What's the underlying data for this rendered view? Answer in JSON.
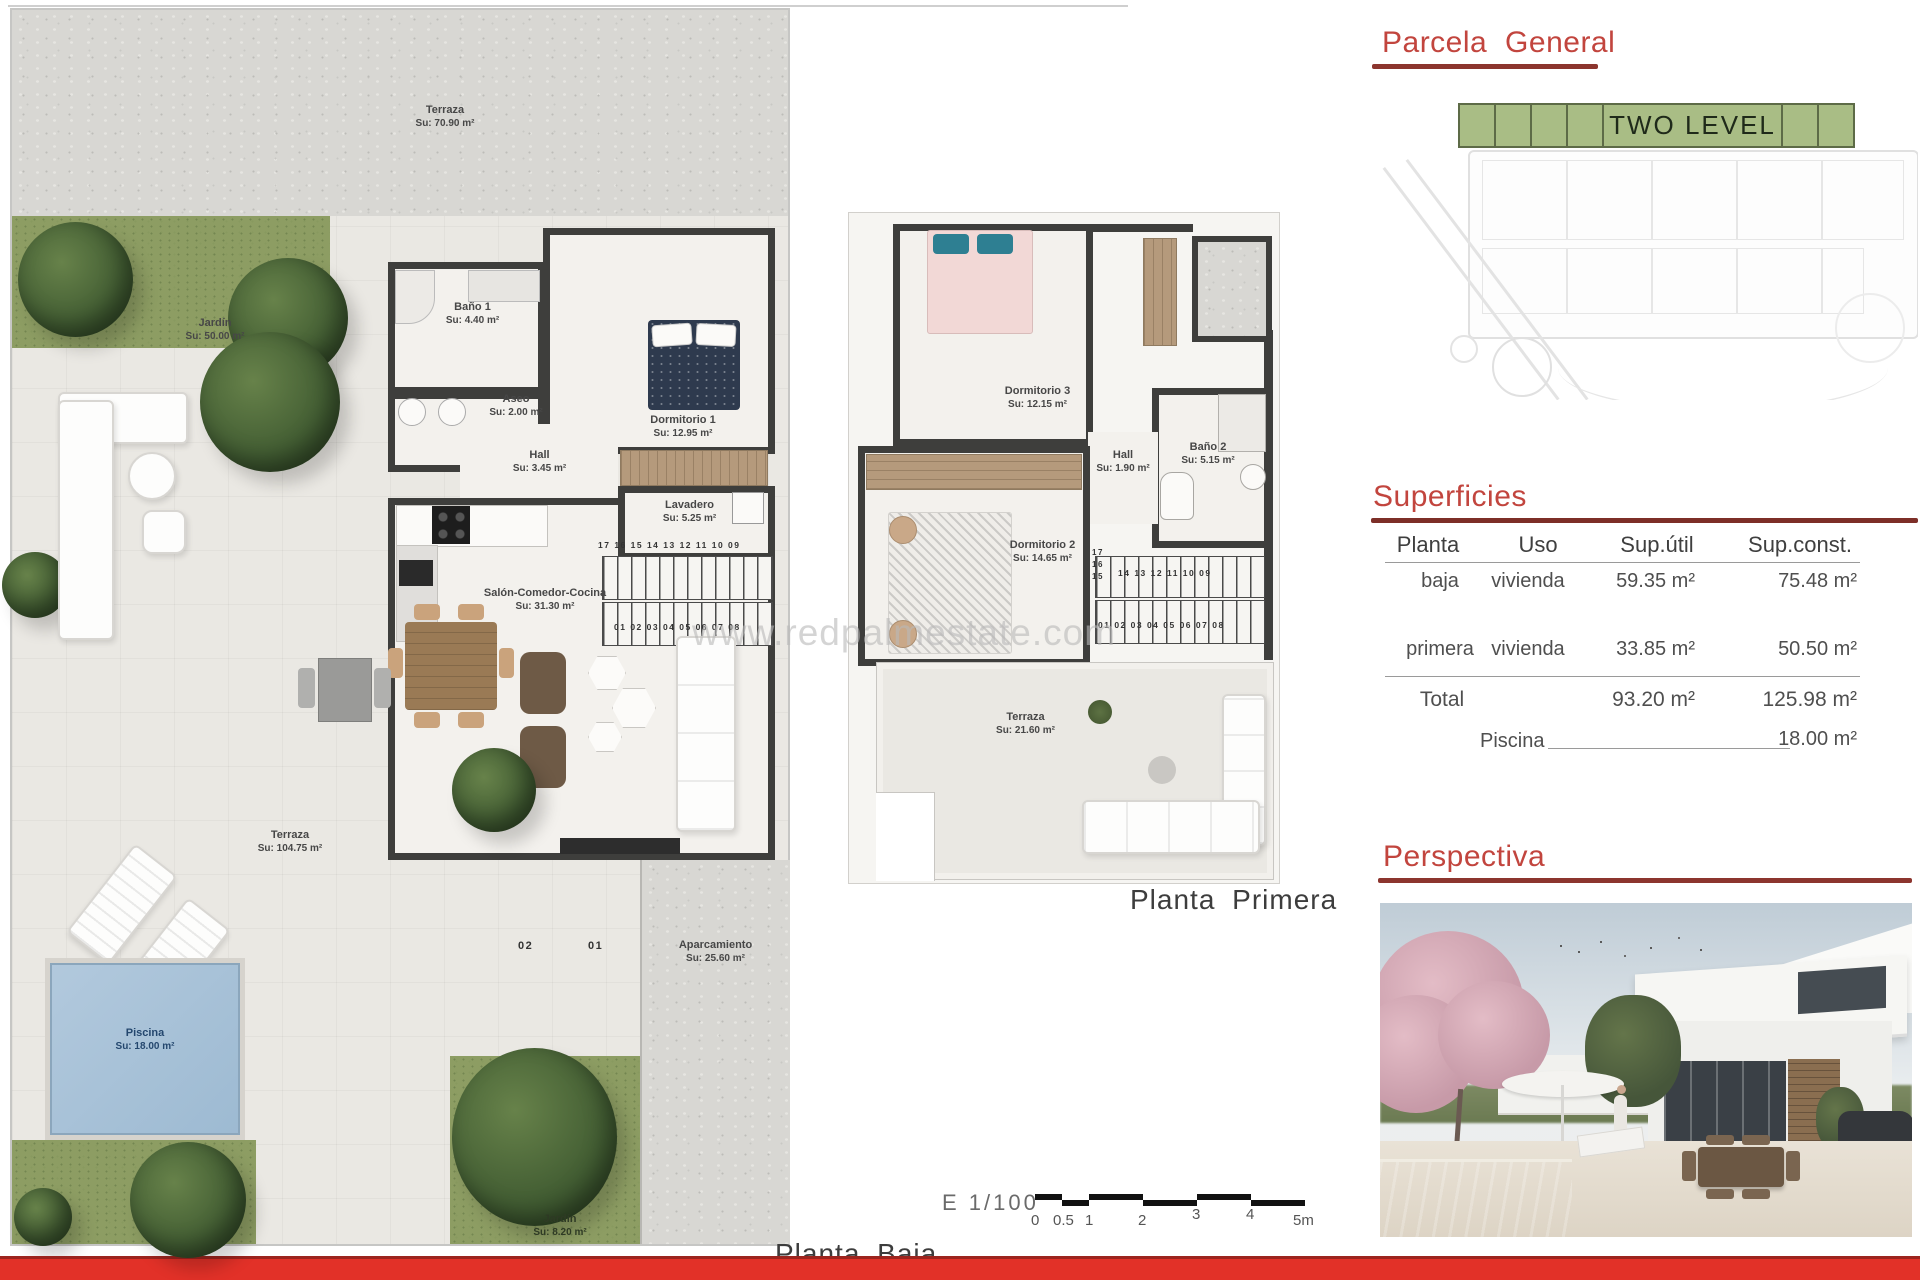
{
  "page": {
    "watermark": "www.redpalmestate.com"
  },
  "headings": {
    "parcela": "Parcela General",
    "superficies": "Superficies",
    "perspectiva": "Perspectiva"
  },
  "parcela": {
    "tag": "TWO LEVEL"
  },
  "superficies": {
    "columns": [
      "Planta",
      "Uso",
      "Sup.útil",
      "Sup.const."
    ],
    "rows": [
      {
        "planta": "baja",
        "uso": "vivienda",
        "util": "59.35 m²",
        "const": "75.48 m²"
      },
      {
        "planta": "primera",
        "uso": "vivienda",
        "util": "33.85 m²",
        "const": "50.50 m²"
      }
    ],
    "total_label": "Total",
    "total_util": "93.20 m²",
    "total_const": "125.98 m²",
    "piscina_label": "Piscina",
    "piscina_value": "18.00 m²"
  },
  "planta_baja": {
    "label": "Planta Baja",
    "terraza_top": {
      "name": "Terraza",
      "area": "Su: 70.90 m²"
    },
    "jardin": {
      "name": "Jardín",
      "area": "Su: 50.00 m²"
    },
    "bano1": {
      "name": "Baño 1",
      "area": "Su: 4.40 m²"
    },
    "aseo": {
      "name": "Aseo",
      "area": "Su: 2.00 m²"
    },
    "hall": {
      "name": "Hall",
      "area": "Su: 3.45 m²"
    },
    "dormitorio1": {
      "name": "Dormitorio 1",
      "area": "Su: 12.95 m²"
    },
    "lavadero": {
      "name": "Lavadero",
      "area": "Su: 5.25 m²"
    },
    "salon": {
      "name": "Salón-Comedor-Cocina",
      "area": "Su: 31.30 m²"
    },
    "terraza_main": {
      "name": "Terraza",
      "area": "Su: 104.75 m²"
    },
    "piscina": {
      "name": "Piscina",
      "area": "Su: 18.00 m²"
    },
    "aparcamiento": {
      "name": "Aparcamiento",
      "area": "Su: 25.60 m²"
    },
    "jardin_bottom": {
      "name": "Jardín",
      "area": "Su: 8.20 m²"
    },
    "stairs_upper": "17 16 15 14 13 12 11 10 09",
    "stairs_lower": "01 02 03 04 05 06 07 08",
    "parking": {
      "p2": "02",
      "p1": "01"
    }
  },
  "planta_primera": {
    "label": "Planta Primera",
    "dormitorio3": {
      "name": "Dormitorio 3",
      "area": "Su: 12.15 m²"
    },
    "hall": {
      "name": "Hall",
      "area": "Su: 1.90 m²"
    },
    "bano2": {
      "name": "Baño 2",
      "area": "Su: 5.15 m²"
    },
    "dormitorio2": {
      "name": "Dormitorio 2",
      "area": "Su: 14.65 m²"
    },
    "terraza": {
      "name": "Terraza",
      "area": "Su: 21.60 m²"
    },
    "stairs_mid": "14 13 12 11 10 09",
    "stairs_lower": "01 02 03 04 05 06 07 08",
    "stairs_side_a": "17",
    "stairs_side_b": "16",
    "stairs_side_c": "15"
  },
  "scalebar": {
    "label": "E 1/100",
    "ticks": [
      "0",
      "0.5",
      "1",
      "2",
      "3",
      "4",
      "5m"
    ]
  }
}
